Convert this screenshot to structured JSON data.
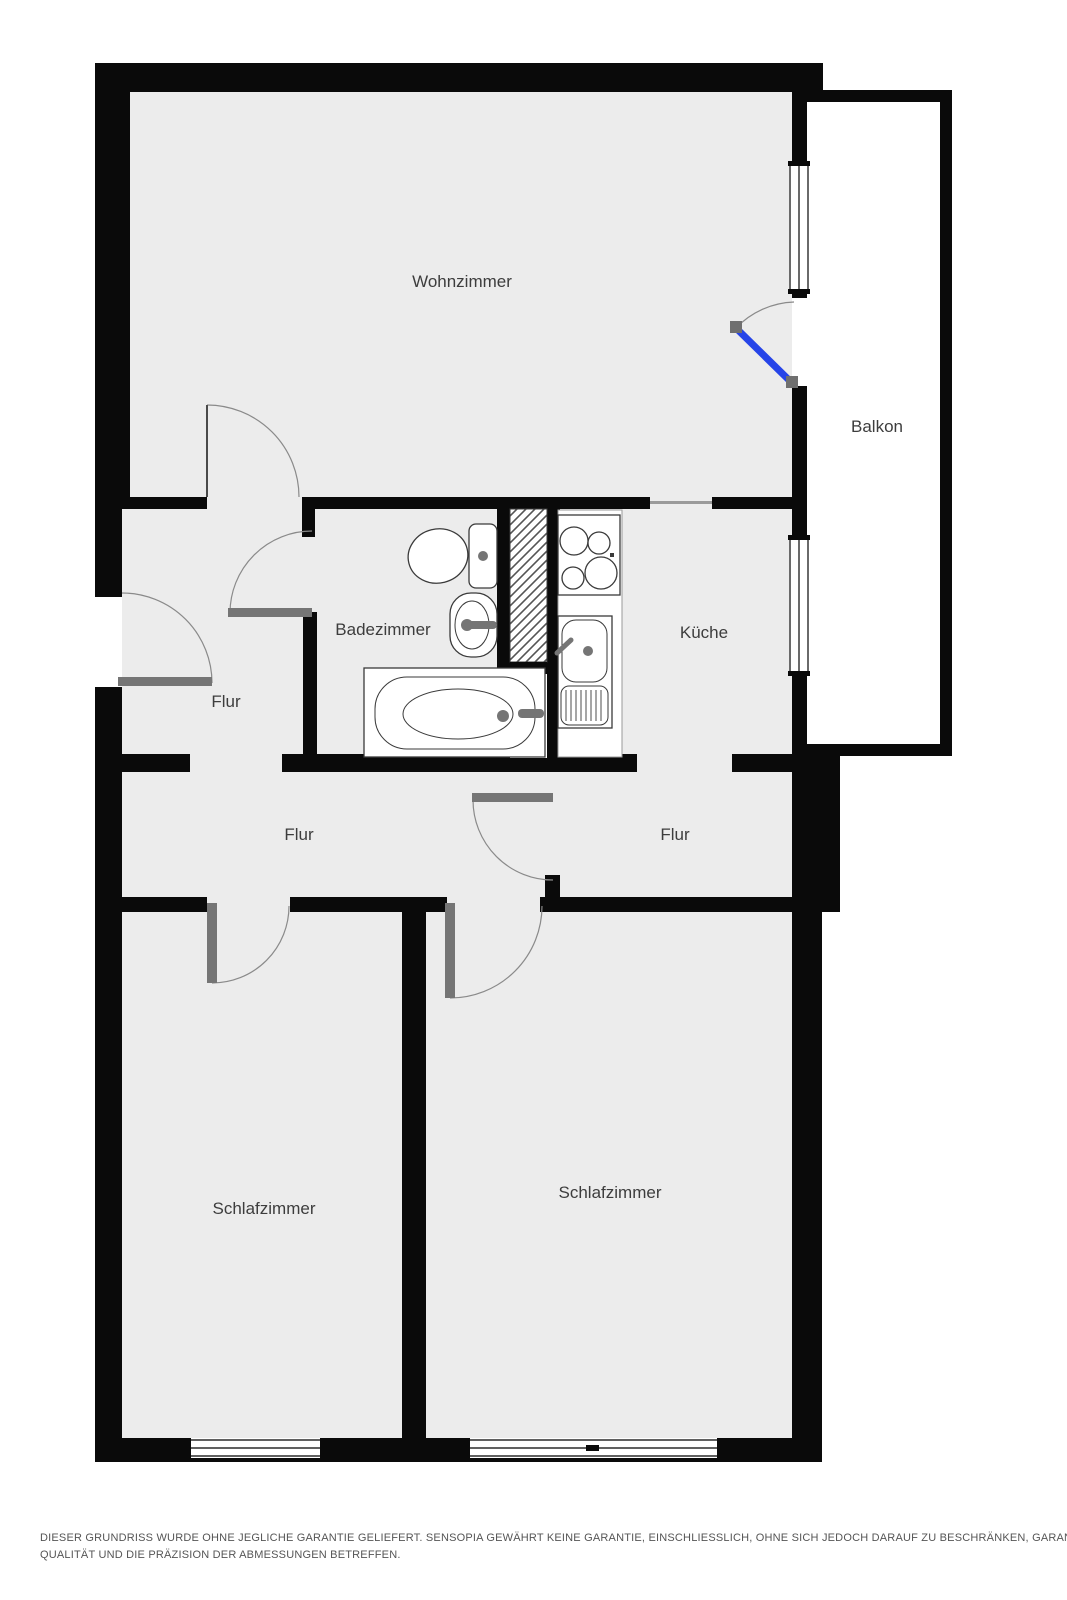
{
  "plan": {
    "rooms": {
      "living": "Wohnzimmer",
      "balcony": "Balkon",
      "bathroom": "Badezimmer",
      "kitchen": "Küche",
      "hall_top": "Flur",
      "hall_mid": "Flur",
      "hall_right": "Flur",
      "bedroom_left": "Schlafzimmer",
      "bedroom_right": "Schlafzimmer"
    },
    "colors": {
      "wall": "#0a0a0a",
      "floor": "#ececec",
      "balcony_floor": "#ffffff",
      "door_leaf": "#757575",
      "door_arc": "#8a8a8a",
      "balcony_door": "#2644e8",
      "fixture_line": "#3a3a3a",
      "label": "#3d3d3d",
      "disclaimer": "#555555"
    },
    "disclaimer": {
      "line1": "DIESER GRUNDRISS WURDE OHNE JEGLICHE GARANTIE GELIEFERT. SENSOPIA GEWÄHRT KEINE GARANTIE, EINSCHLIESSLICH, OHNE SICH JEDOCH DARAUF ZU BESCHRÄNKEN, GARANTIEN, DIE DIE",
      "line2": "QUALITÄT UND DIE PRÄZISION DER ABMESSUNGEN BETREFFEN."
    }
  }
}
